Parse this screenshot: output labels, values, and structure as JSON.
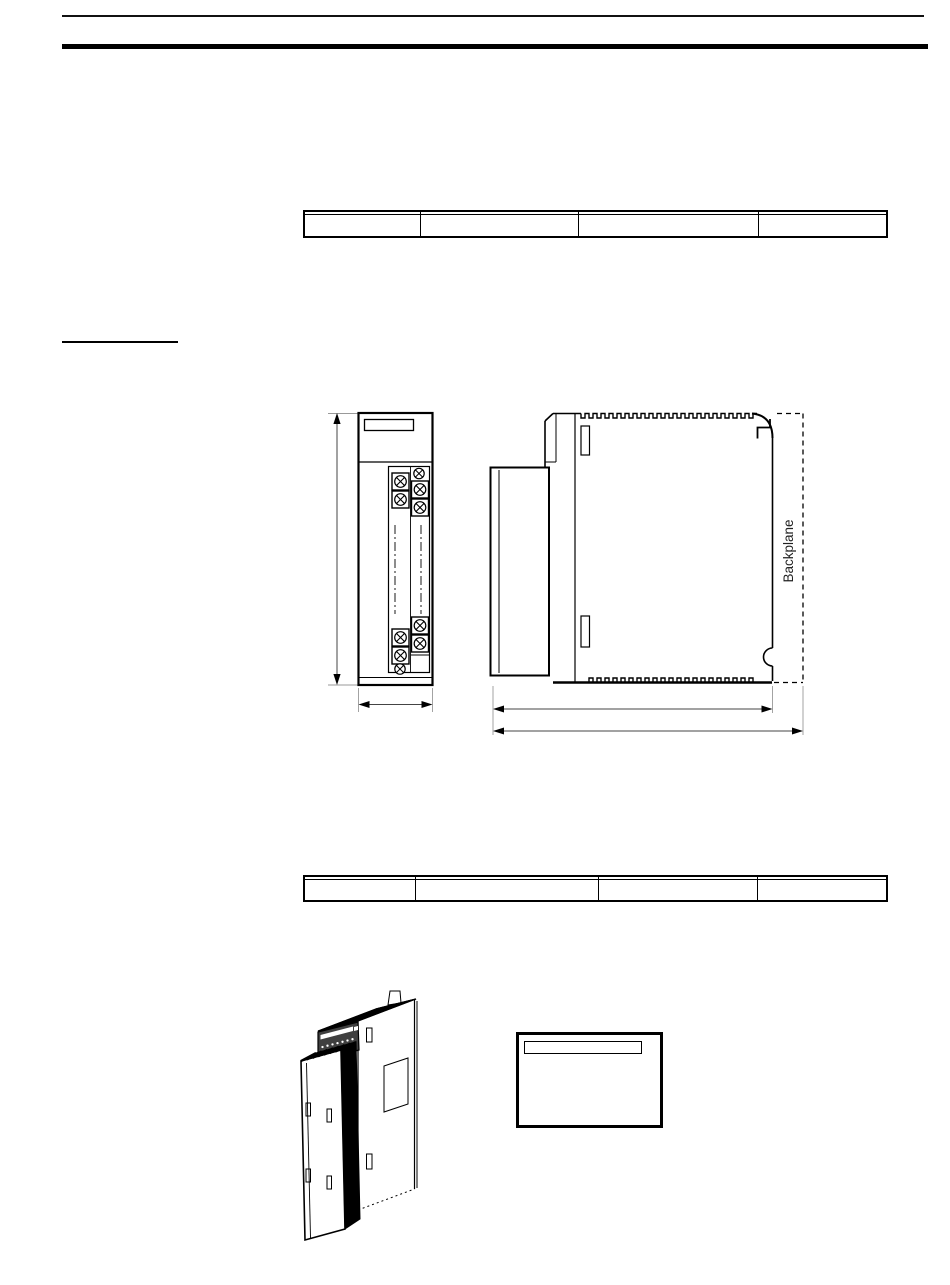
{
  "colors": {
    "ink": "#000000",
    "paper": "#ffffff",
    "dimension_line": "#444444",
    "extension_line": "#999999",
    "led_panel": "#3f3f3f"
  },
  "tables": {
    "top": {
      "col_widths_pct": [
        20,
        27,
        31,
        22
      ],
      "rows": [
        [
          "",
          "",
          "",
          ""
        ],
        [
          "",
          "",
          "",
          ""
        ]
      ]
    },
    "bottom": {
      "col_widths_pct": [
        19,
        31,
        27,
        22
      ],
      "rows": [
        [
          "",
          "",
          "",
          ""
        ],
        [
          "",
          "",
          "",
          ""
        ]
      ]
    }
  },
  "drawing": {
    "backplane_label": "Backplane"
  },
  "label_box": {
    "text": "",
    "strip_text": ""
  }
}
